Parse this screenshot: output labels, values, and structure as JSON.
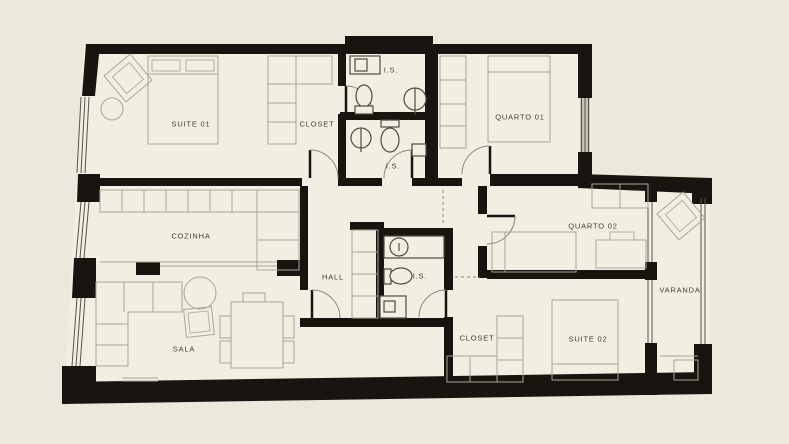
{
  "plan": {
    "title": "apartment-floor-plan",
    "colors": {
      "background": "#ece9dc",
      "floor": "#f2efe2",
      "walls": "#181510",
      "furniture_lines": "#a8a596",
      "labels": "#3f3c34"
    },
    "rooms": {
      "suite01": {
        "label": "SUITE 01"
      },
      "closet01": {
        "label": "CLOSET"
      },
      "is1": {
        "label": "I.S."
      },
      "is2": {
        "label": "I.S."
      },
      "quarto01": {
        "label": "QUARTO 01"
      },
      "cozinha": {
        "label": "COZINHA"
      },
      "hall": {
        "label": "HALL"
      },
      "is3": {
        "label": "I.S."
      },
      "quarto02": {
        "label": "QUARTO 02"
      },
      "sala": {
        "label": "SALA"
      },
      "closet02": {
        "label": "CLOSET"
      },
      "suite02": {
        "label": "SUITE 02"
      },
      "varanda": {
        "label": "VARANDA"
      }
    }
  }
}
